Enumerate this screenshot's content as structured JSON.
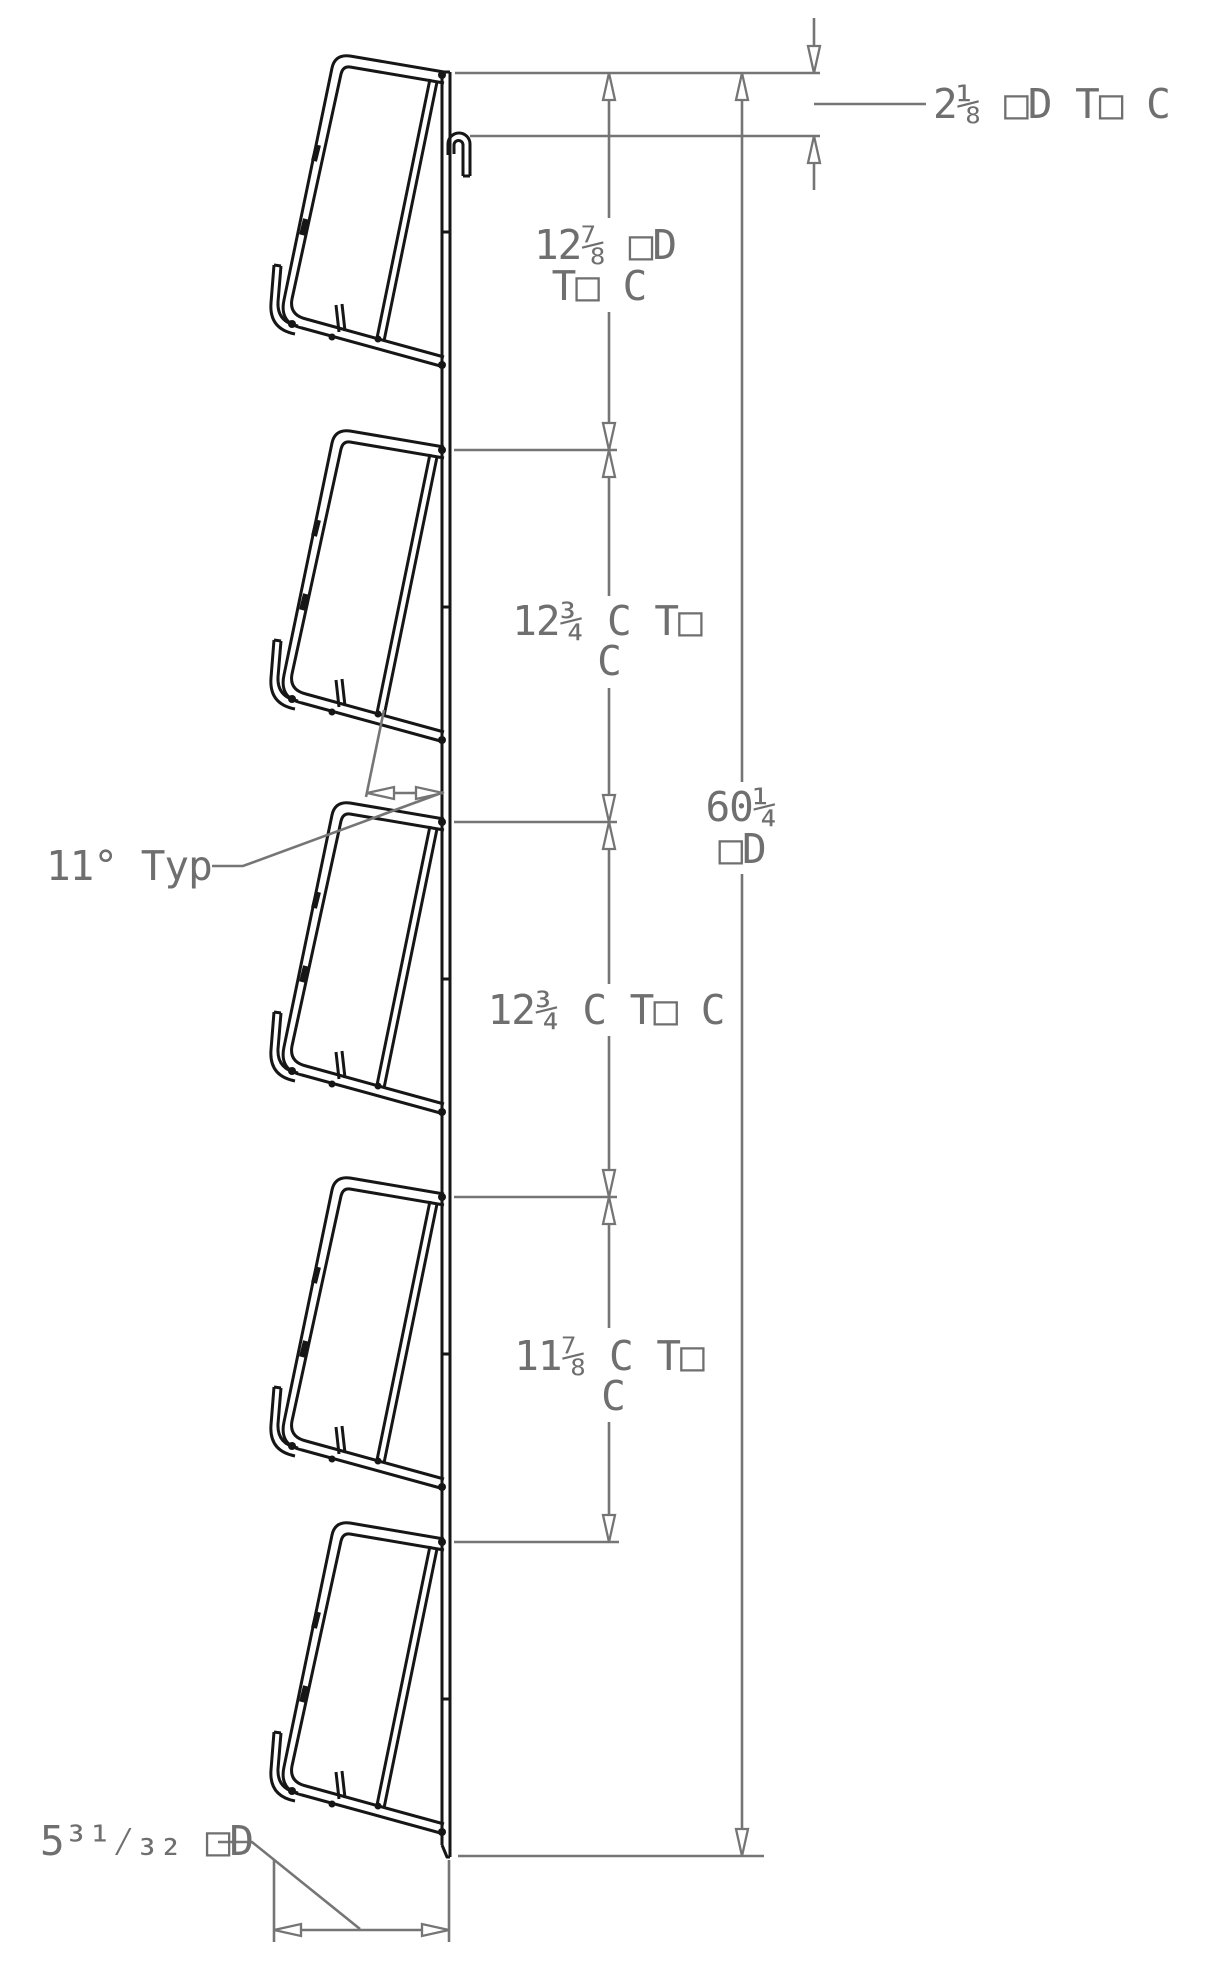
{
  "drawing": {
    "type": "cad-side-elevation",
    "description": "Wall-mounted five-pocket literature rack, side profile with dimension chain",
    "pocket_count": 5,
    "colors": {
      "geometry": "#161616",
      "dimension": "#757575",
      "background": "#ffffff"
    },
    "dimensions": {
      "top_offset": "2⅛ □D T□ C",
      "spacing1_line1": "12⅞ □D",
      "spacing1_line2": "T□ C",
      "spacing2_line1": "12¾ C T□",
      "spacing2_line2": "C",
      "overall_line1": "60¼",
      "overall_line2": "□D",
      "spacing3": "12¾ C T□ C",
      "spacing4_line1": "11⅞ C T□",
      "spacing4_line2": "C",
      "angle": "11° Typ",
      "depth": "5³¹⁄₃₂ □D"
    }
  }
}
